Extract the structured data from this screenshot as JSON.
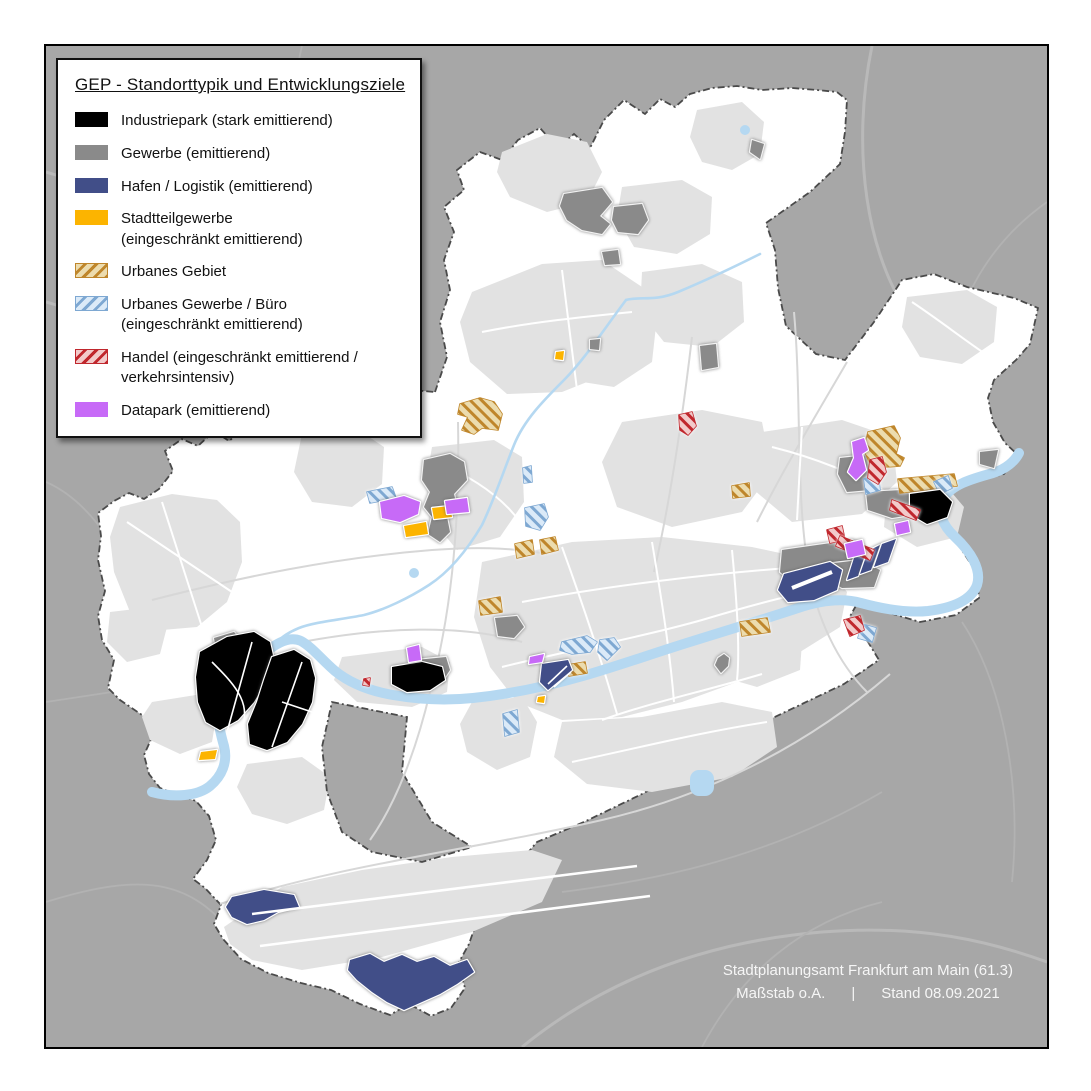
{
  "legend": {
    "title": "GEP - Standorttypik und Entwicklungsziele",
    "items": [
      {
        "key": "industriepark",
        "label": "Industriepark (stark emittierend)",
        "sublabel": ""
      },
      {
        "key": "gewerbe",
        "label": "Gewerbe (emittierend)",
        "sublabel": ""
      },
      {
        "key": "hafen",
        "label": "Hafen / Logistik (emittierend)",
        "sublabel": ""
      },
      {
        "key": "stadtteilgewerbe",
        "label": "Stadtteilgewerbe",
        "sublabel": "(eingeschränkt emittierend)"
      },
      {
        "key": "urbanes-gebiet",
        "label": "Urbanes Gebiet",
        "sublabel": ""
      },
      {
        "key": "urbanes-gewerbe",
        "label": "Urbanes Gewerbe / Büro",
        "sublabel": "(eingeschränkt emittierend)"
      },
      {
        "key": "handel",
        "label": "Handel (eingeschränkt emittierend /",
        "sublabel": "verkehrsintensiv)"
      },
      {
        "key": "datapark",
        "label": "Datapark (emittierend)",
        "sublabel": ""
      }
    ]
  },
  "attribution": {
    "line1": "Stadtplanungsamt Frankfurt am Main (61.3)",
    "scale": "Maßstab o.A.",
    "separator": "|",
    "date": "Stand 08.09.2021"
  },
  "palette": {
    "industriepark": "#000000",
    "gewerbe": "#8a8a8a",
    "hafen": "#414e88",
    "stadtteilgewerbe": "#fcb400",
    "urbanes_gebiet_fill": "#ecdcae",
    "urbanes_gebiet_stripe": "#bf862b",
    "urbanes_gewerbe_fill": "#dbeaf8",
    "urbanes_gewerbe_stripe": "#7ea8d2",
    "handel_fill": "#f2caca",
    "handel_stripe": "#c0272d",
    "datapark": "#c76af7",
    "map_background_outside": "#a7a7a7",
    "city_fill": "#ffffff",
    "settlement_fill": "#e2e2e2",
    "river": "#b5d8f1",
    "boundary_line": "#4a4a4a"
  }
}
